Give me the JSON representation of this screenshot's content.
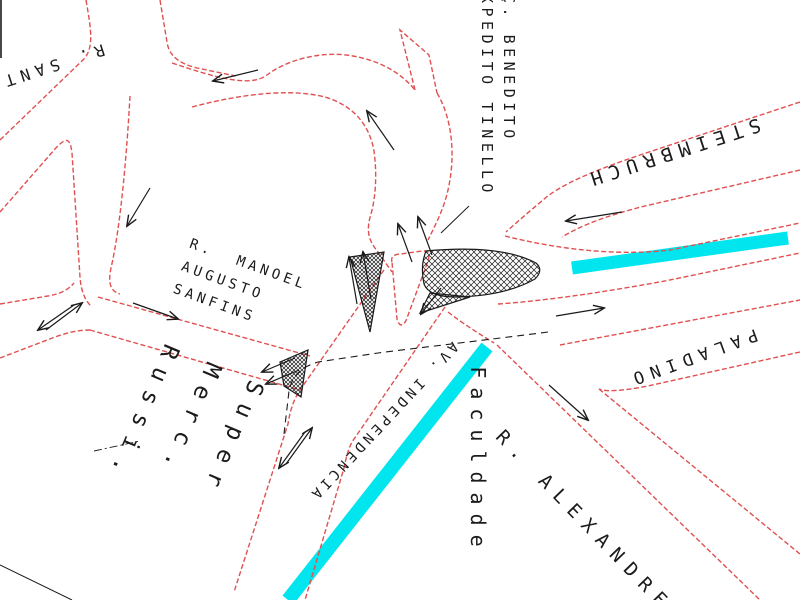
{
  "map": {
    "colors": {
      "road": "#e05050",
      "marking": "#1a1a1a",
      "highlight": "#00e5ee"
    },
    "labels": [
      {
        "id": "r-sant",
        "text": "R. SANT",
        "x": 52,
        "y": 66,
        "rot": 162,
        "size": 16,
        "ls": 6,
        "lh": 1.2,
        "anchor": "c"
      },
      {
        "id": "benedito-tinello",
        "text": "Ç. BENEDITO\nXPEDITO TINELLO",
        "x": 519,
        "y": -6,
        "rot": 90,
        "size": 15,
        "ls": 4.5,
        "lh": 1.45,
        "anchor": "tl"
      },
      {
        "id": "steimbruch",
        "text": "STEIMBRUCH",
        "x": 672,
        "y": 152,
        "rot": 162,
        "size": 19,
        "ls": 7,
        "lh": 1.2,
        "anchor": "c"
      },
      {
        "id": "manoel-sanfins",
        "text": "R.  MANOEL\nAUGUSTO\nSANFINS",
        "x": 240,
        "y": 288,
        "rot": 20,
        "size": 14,
        "ls": 4,
        "lh": 1.7,
        "anchor": "c"
      },
      {
        "id": "super-merc-russi",
        "text": "Super\nMerc.\nRussi.",
        "x": 185,
        "y": 432,
        "rot": 113,
        "size": 23,
        "ls": 11,
        "lh": 2.0,
        "anchor": "c"
      },
      {
        "id": "av-independencia",
        "text": "AV. INDEPENDENCIA",
        "x": 383,
        "y": 421,
        "rot": 133,
        "size": 14,
        "ls": 4,
        "lh": 1.2,
        "anchor": "c"
      },
      {
        "id": "faculdade",
        "text": "Faculdade",
        "x": 478,
        "y": 461,
        "rot": 90,
        "size": 20,
        "ls": 9,
        "lh": 1.2,
        "anchor": "c"
      },
      {
        "id": "paladino",
        "text": "PALADINO",
        "x": 692,
        "y": 357,
        "rot": 160,
        "size": 17,
        "ls": 7,
        "lh": 1.2,
        "anchor": "c"
      },
      {
        "id": "r-alexandre",
        "text": "R. ALEXANDRE",
        "x": 584,
        "y": 522,
        "rot": 46,
        "size": 19,
        "ls": 9,
        "lh": 1.2,
        "anchor": "c"
      }
    ],
    "roads": [
      {
        "name": "nw-north-arm-left-edge",
        "d": "M86,0 C92,34 93,46 85,58 L0,140"
      },
      {
        "name": "nw-west-arm-south-edge",
        "d": "M0,212 L55,149 C66,137 70,137 72,153 L80,277 C81,291 85,301 92,307"
      },
      {
        "name": "nw-north-arm-right-edge",
        "d": "M160,0 L167,42 C169,57 181,64 197,68 L236,76"
      },
      {
        "name": "loop-north-edge",
        "d": "M172,63 C214,77 250,88 267,75 C285,61 320,50 353,56 C381,61 401,73 415,90"
      },
      {
        "name": "tinello-stub-edge",
        "d": "M415,90 L400,30 L429,55 L437,93"
      },
      {
        "name": "loop-east-edge",
        "d": "M437,93 C452,118 456,155 448,190 C444,208 436,224 428,240"
      },
      {
        "name": "loop-inner-edge",
        "d": "M192,107 C248,92 300,88 331,99 C357,109 370,128 374,151 C377,173 376,196 371,214 C366,230 368,240 378,252 L392,272"
      },
      {
        "name": "steimbruch-north-edge",
        "d": "M800,102 L640,155 C590,172 560,185 543,200 C530,211 517,222 506,232"
      },
      {
        "name": "steimbruch-south-edge",
        "d": "M800,170 L645,206 C605,216 580,226 562,237"
      },
      {
        "name": "median-lane-upper-edge",
        "d": "M505,236 C560,250 620,256 670,250 L800,223"
      },
      {
        "name": "median-lane-lower-edge",
        "d": "M498,304 C555,300 615,290 665,281 L800,253"
      },
      {
        "name": "paladino-north-edge",
        "d": "M560,345 L800,300"
      },
      {
        "name": "paladino-south-edge",
        "d": "M800,352 L648,386 C622,391 606,392 599,389"
      },
      {
        "name": "alexandre-north-edge",
        "d": "M599,389 L800,554"
      },
      {
        "name": "alexandre-south-edge",
        "d": "M497,345 L760,600"
      },
      {
        "name": "faculdade-corner-edge",
        "d": "M448,312 C462,323 478,333 494,343"
      },
      {
        "name": "independencia-west-edge",
        "d": "M384,270 L300,390 C293,401 290,411 288,424 L234,592"
      },
      {
        "name": "independencia-east-edge",
        "d": "M445,307 L352,442 C348,450 346,458 344,468 L305,600"
      },
      {
        "name": "sanfins-north-edge",
        "d": "M98,297 L310,356"
      },
      {
        "name": "sanfins-south-edge",
        "d": "M90,330 L300,390"
      },
      {
        "name": "south-arm-east-edge",
        "d": "M130,96 C127,150 121,225 111,268 C108,283 110,291 120,294"
      },
      {
        "name": "west-arm-north-edge",
        "d": "M0,304 L48,296 C60,294 68,290 74,283"
      },
      {
        "name": "west-arm-south-edge",
        "d": "M0,358 L55,337 C72,331 82,330 90,330"
      },
      {
        "name": "junction-triangle-island",
        "d": "M392,262 C390,256 396,254 401,254 L422,251 C429,250 430,255 428,261 L407,318 C404,327 399,327 397,319 Z"
      }
    ],
    "islands": [
      {
        "name": "crosshatched-teardrop-island",
        "d": "M426,251 Q500,244 536,263 Q544,270 535,279 Q505,296 456,297 Q429,297 424,284 Q420,266 426,251 Z",
        "pattern": "xh"
      },
      {
        "name": "hatched-island-tail",
        "d": "M430,293 L470,297 L420,313 Z",
        "pattern": "xh"
      },
      {
        "name": "hatched-triangle-island",
        "d": "M350,257 L384,252 L370,332 Z",
        "pattern": "xh2"
      },
      {
        "name": "hatched-sliver-island",
        "d": "M280,362 L308,350 L301,397 L284,386 Z",
        "pattern": "xh2"
      }
    ],
    "highlight_bands": [
      {
        "name": "steimbruch-cyan-band",
        "x1": 572,
        "y1": 268,
        "x2": 788,
        "y2": 238,
        "w": 13
      },
      {
        "name": "independencia-cyan-band",
        "x1": 487,
        "y1": 347,
        "x2": 288,
        "y2": 600,
        "w": 14
      }
    ],
    "arrows": [
      {
        "name": "arrow-loop-west",
        "x1": 258,
        "y1": 70,
        "x2": 213,
        "y2": 81
      },
      {
        "name": "arrow-loop-up",
        "x1": 394,
        "y1": 150,
        "x2": 367,
        "y2": 111
      },
      {
        "name": "arrow-steimbruch-west",
        "x1": 622,
        "y1": 212,
        "x2": 566,
        "y2": 221
      },
      {
        "name": "arrow-southarm-down",
        "x1": 150,
        "y1": 188,
        "x2": 127,
        "y2": 226
      },
      {
        "name": "arrow-westarm-up",
        "x1": 46,
        "y1": 330,
        "x2": 82,
        "y2": 303
      },
      {
        "name": "arrow-westarm-down",
        "x1": 74,
        "y1": 305,
        "x2": 38,
        "y2": 330
      },
      {
        "name": "arrow-sanfins-east",
        "x1": 133,
        "y1": 303,
        "x2": 178,
        "y2": 319
      },
      {
        "name": "arrow-neck-up-1",
        "x1": 412,
        "y1": 262,
        "x2": 398,
        "y2": 224
      },
      {
        "name": "arrow-neck-up-2",
        "x1": 432,
        "y1": 255,
        "x2": 418,
        "y2": 217
      },
      {
        "name": "arrow-junction-down",
        "x1": 441,
        "y1": 288,
        "x2": 421,
        "y2": 314
      },
      {
        "name": "arrow-alexandre-se",
        "x1": 549,
        "y1": 385,
        "x2": 588,
        "y2": 420
      },
      {
        "name": "arrow-paladino-east",
        "x1": 556,
        "y1": 316,
        "x2": 604,
        "y2": 308
      },
      {
        "name": "arrow-independencia-up",
        "x1": 286,
        "y1": 464,
        "x2": 312,
        "y2": 428
      },
      {
        "name": "arrow-independencia-down",
        "x1": 305,
        "y1": 432,
        "x2": 279,
        "y2": 468
      },
      {
        "name": "arrow-sanfins-end-1",
        "x1": 295,
        "y1": 358,
        "x2": 262,
        "y2": 372
      },
      {
        "name": "arrow-sanfins-end-2",
        "x1": 299,
        "y1": 370,
        "x2": 266,
        "y2": 384
      },
      {
        "name": "arrow-island-up-1",
        "x1": 357,
        "y1": 304,
        "x2": 349,
        "y2": 257
      },
      {
        "name": "arrow-island-up-2",
        "x1": 371,
        "y1": 299,
        "x2": 363,
        "y2": 252
      }
    ],
    "dashed_lines": [
      {
        "name": "dashed-guide-line",
        "d": "M548,332 C470,342 400,350 378,353 L318,362 C301,367 292,376 289,391 L284,434"
      }
    ],
    "lines": [
      {
        "name": "label-leader-line",
        "d": "M441,233 L469,206",
        "w": 1
      },
      {
        "name": "corner-boundary-line",
        "d": "M0,565 L72,600",
        "w": 1
      },
      {
        "name": "lot-dashdot-line",
        "d": "M94,451 L140,441",
        "w": 0.9,
        "dash": "8 3 2 3"
      },
      {
        "name": "scan-edge-line",
        "d": "M1,0 L1,58",
        "w": 1.6
      }
    ]
  }
}
